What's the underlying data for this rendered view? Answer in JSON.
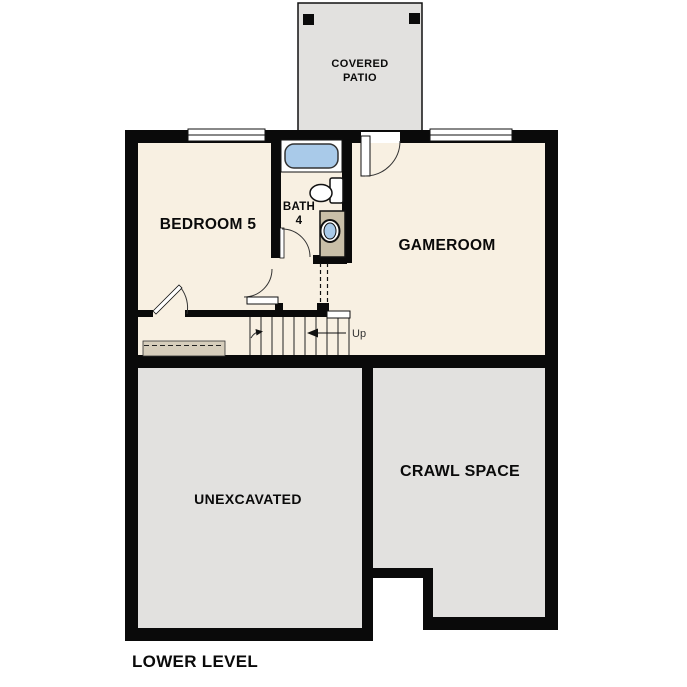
{
  "floorplan": {
    "title": "LOWER LEVEL",
    "labels": {
      "covered_patio_line1": "COVERED",
      "covered_patio_line2": "PATIO",
      "bedroom": "BEDROOM 5",
      "bath_line1": "BATH",
      "bath_line2": "4",
      "gameroom": "GAMEROOM",
      "unexcavated": "UNEXCAVATED",
      "crawl_space": "CRAWL SPACE",
      "stairs_direction": "Up"
    },
    "colors": {
      "wall": "#0a0a0a",
      "room_fill": "#f8f0e2",
      "concrete_fill": "#e2e1df",
      "vanity_fill": "#c9bfa8",
      "strip_fill": "#d6cdbb",
      "fixture_blue": "#a9cae9",
      "background": "#ffffff"
    }
  }
}
